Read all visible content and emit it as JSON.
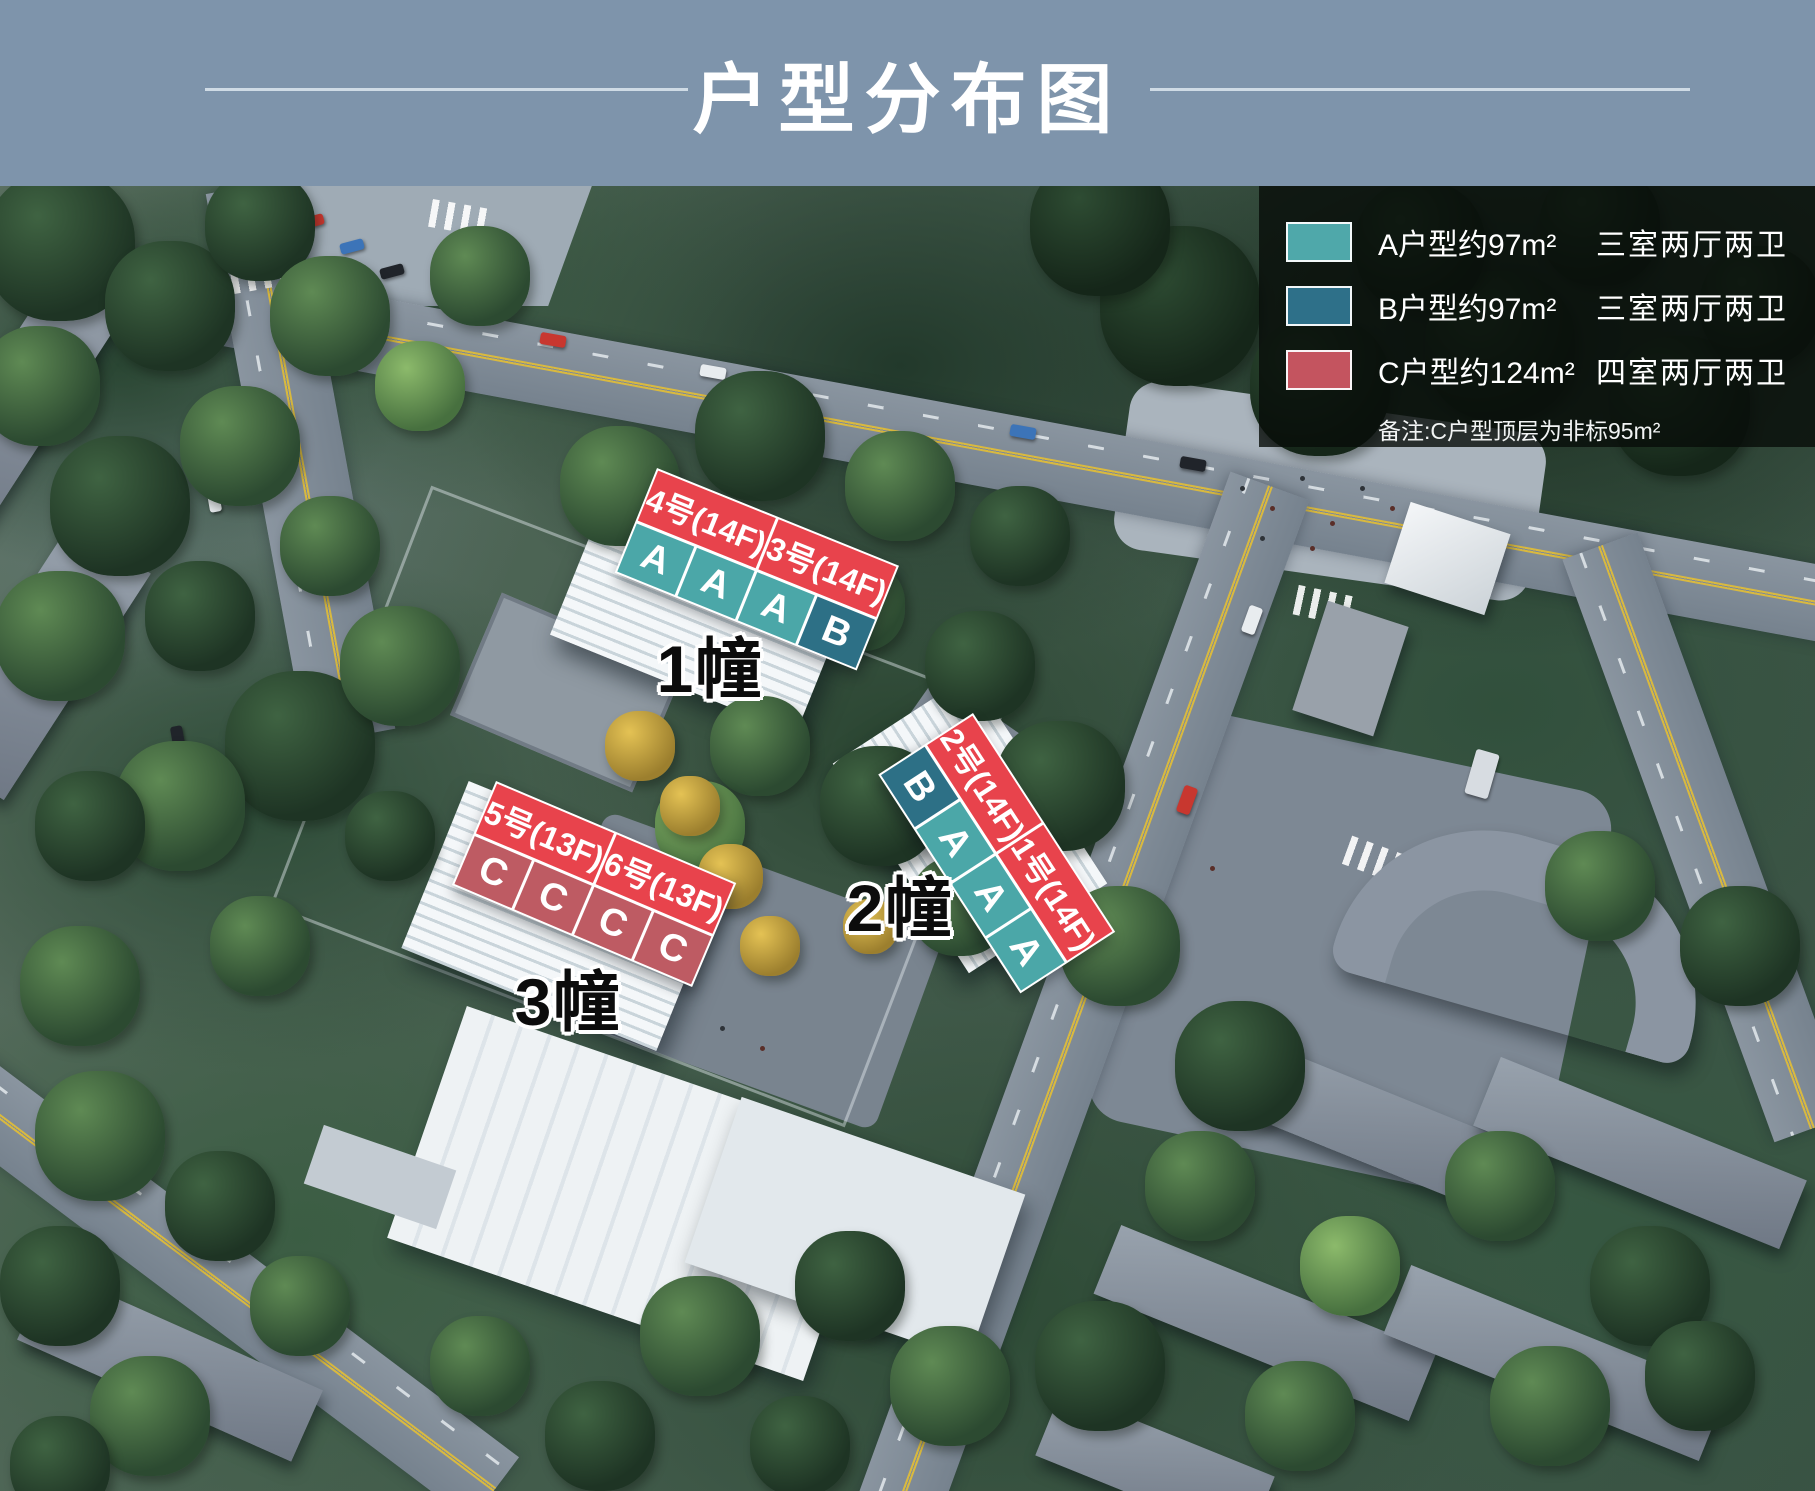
{
  "header": {
    "title": "户型分布图"
  },
  "legend": {
    "items": [
      {
        "type_key": "A",
        "label": "A户型约97m²",
        "desc": "三室两厅两卫"
      },
      {
        "type_key": "B",
        "label": "B户型约97m²",
        "desc": "三室两厅两卫"
      },
      {
        "type_key": "C",
        "label": "C户型约124m²",
        "desc": "四室两厅两卫"
      }
    ],
    "note": "备注:C户型顶层为非标95m²"
  },
  "buildings": [
    {
      "name": "1幢",
      "units": [
        "4号(14F)",
        "3号(14F)"
      ],
      "cells": [
        "A",
        "A",
        "A",
        "B"
      ]
    },
    {
      "name": "2幢",
      "units": [
        "2号(14F)",
        "1号(14F)"
      ],
      "cells": [
        "B",
        "A",
        "A",
        "A"
      ]
    },
    {
      "name": "3幢",
      "units": [
        "5号(13F)",
        "6号(13F)"
      ],
      "cells": [
        "C",
        "C",
        "C",
        "C"
      ]
    }
  ],
  "colors": {
    "header_bg": "#7E94AB",
    "header_line": "#DDE7EF",
    "title_text": "#FFFFFF",
    "type_a": "#4FA8AA",
    "type_b": "#2E7089",
    "type_c": "#C4545F",
    "strip_red": "#E8434C",
    "cell_a": "#4BA7A8",
    "cell_b": "#2D7086",
    "cell_c": "#BE5B63"
  }
}
